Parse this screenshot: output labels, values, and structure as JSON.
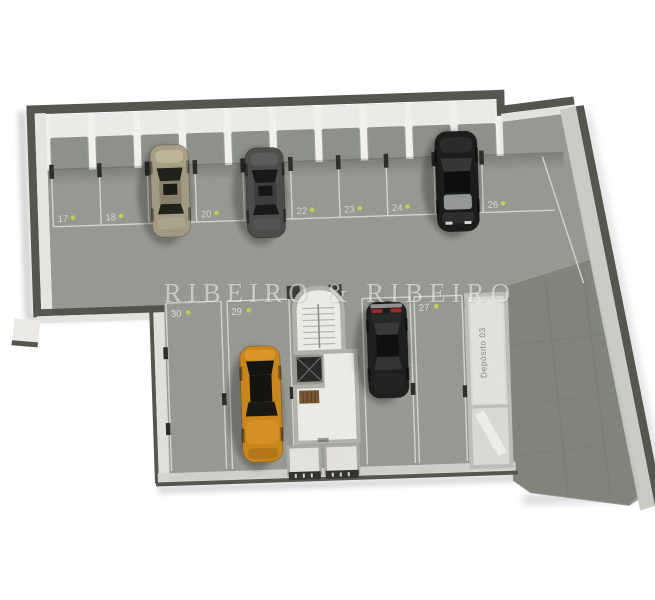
{
  "watermark": {
    "text": "RIBEIRO & RIBEIRO",
    "color": "#f6f6f3"
  },
  "deposito": {
    "label": "Depósito 03"
  },
  "spots": {
    "upper": [
      "17",
      "18",
      "19",
      "20",
      "21",
      "22",
      "23",
      "24",
      "25",
      "26"
    ],
    "lower": [
      "30",
      "29",
      "28",
      "27"
    ]
  },
  "cars": {
    "spot19": {
      "color": "#a89e86"
    },
    "spot21": {
      "color": "#4d4f4c"
    },
    "spot25": {
      "color": "#1c1e1d"
    },
    "spot29": {
      "color": "#cf8a1e"
    },
    "spot28": {
      "color": "#1f2120"
    }
  },
  "colors": {
    "floor": "#9b9d96",
    "ramp": "#85887f",
    "wall_dark": "#55564e",
    "wall_light": "#e4e4e0",
    "parking_line": "#d9d9d3",
    "label_text": "#dcdcd6",
    "marker": "#c9d64e"
  }
}
